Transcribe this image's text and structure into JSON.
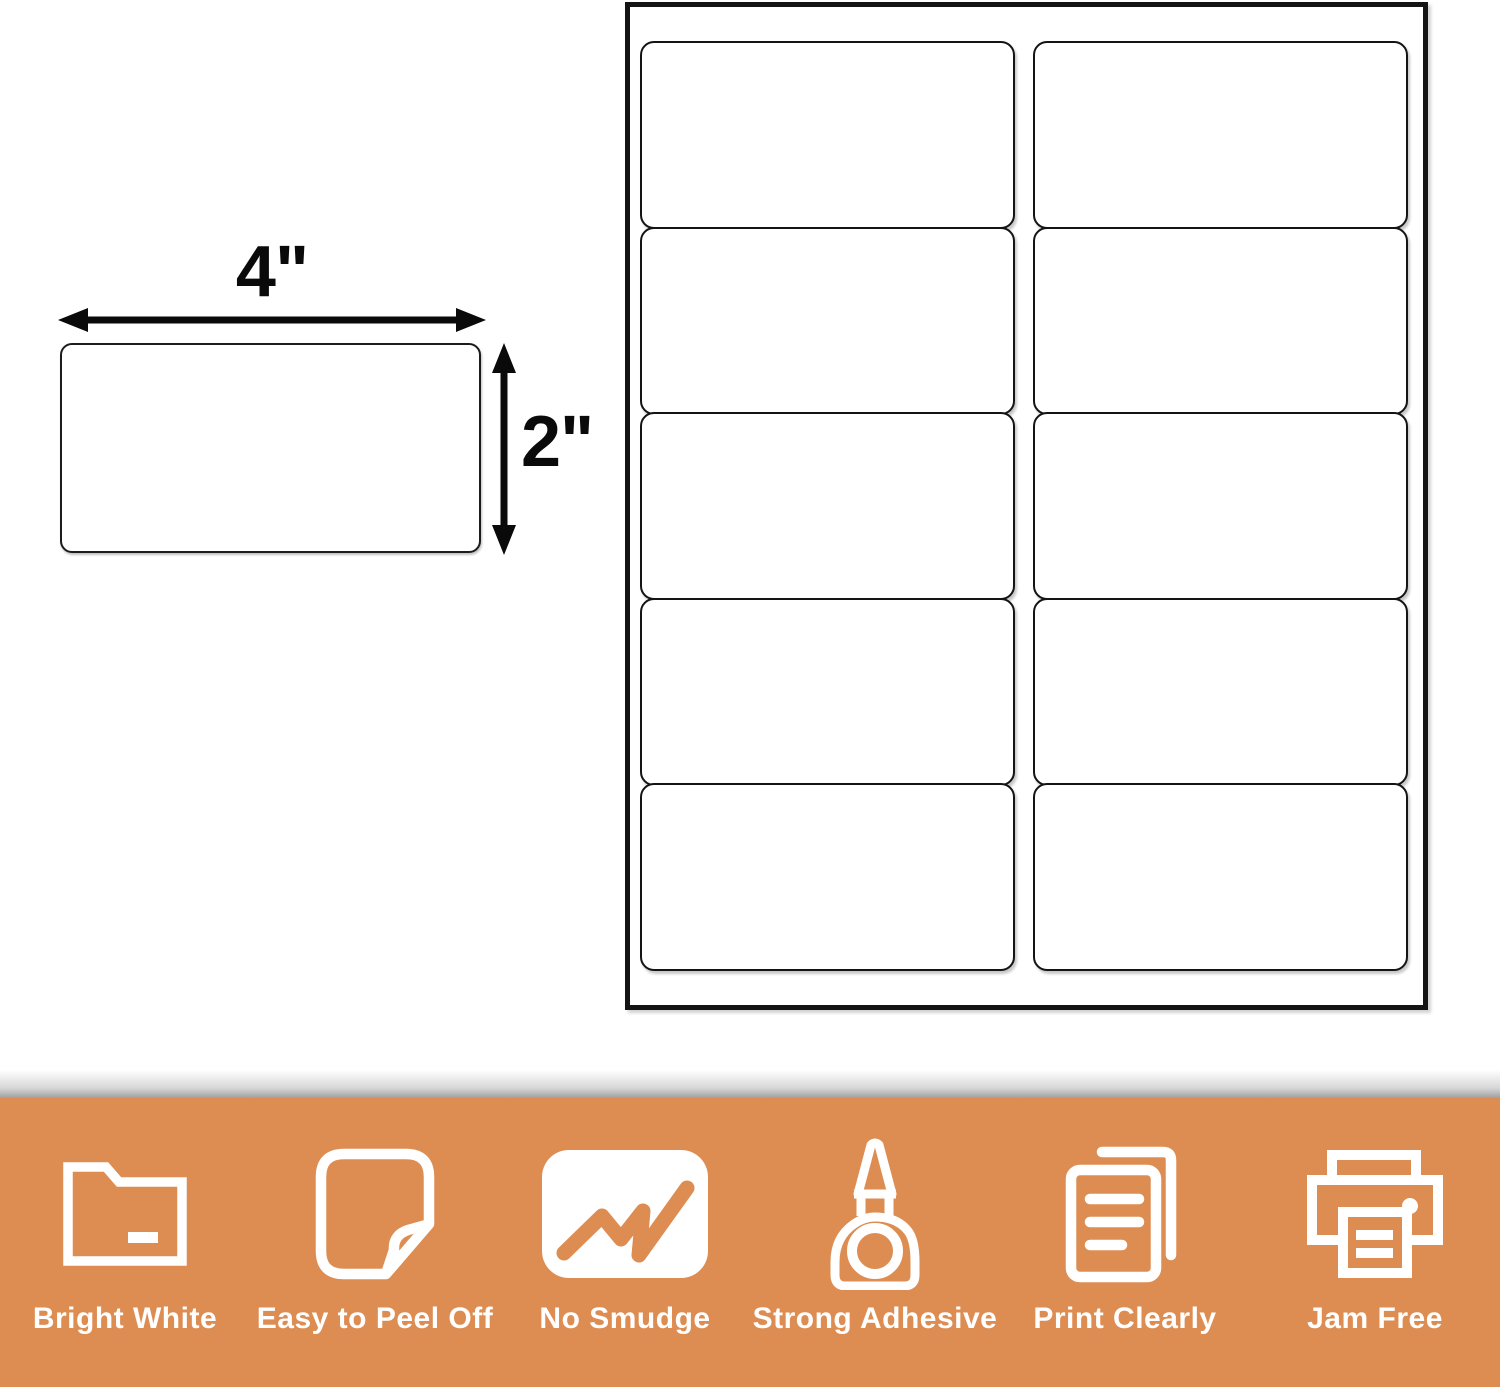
{
  "colors": {
    "background": "#ffffff",
    "banner_orange": "#de8d52",
    "ink_black": "#141414",
    "banner_text": "#ffffff"
  },
  "dimension_diagram": {
    "width_label": "4\"",
    "height_label": "2\""
  },
  "label_sheet": {
    "columns": 2,
    "rows": 5
  },
  "features": [
    {
      "name": "bright-white",
      "icon": "folder-icon",
      "label": "Bright White"
    },
    {
      "name": "easy-to-peel-off",
      "icon": "sticker-peel-icon",
      "label": "Easy to Peel Off"
    },
    {
      "name": "no-smudge",
      "icon": "marker-scribble-icon",
      "label": "No Smudge"
    },
    {
      "name": "strong-adhesive",
      "icon": "glue-bottle-icon",
      "label": "Strong Adhesive"
    },
    {
      "name": "print-clearly",
      "icon": "documents-icon",
      "label": "Print Clearly"
    },
    {
      "name": "jam-free",
      "icon": "printer-icon",
      "label": "Jam Free"
    }
  ]
}
